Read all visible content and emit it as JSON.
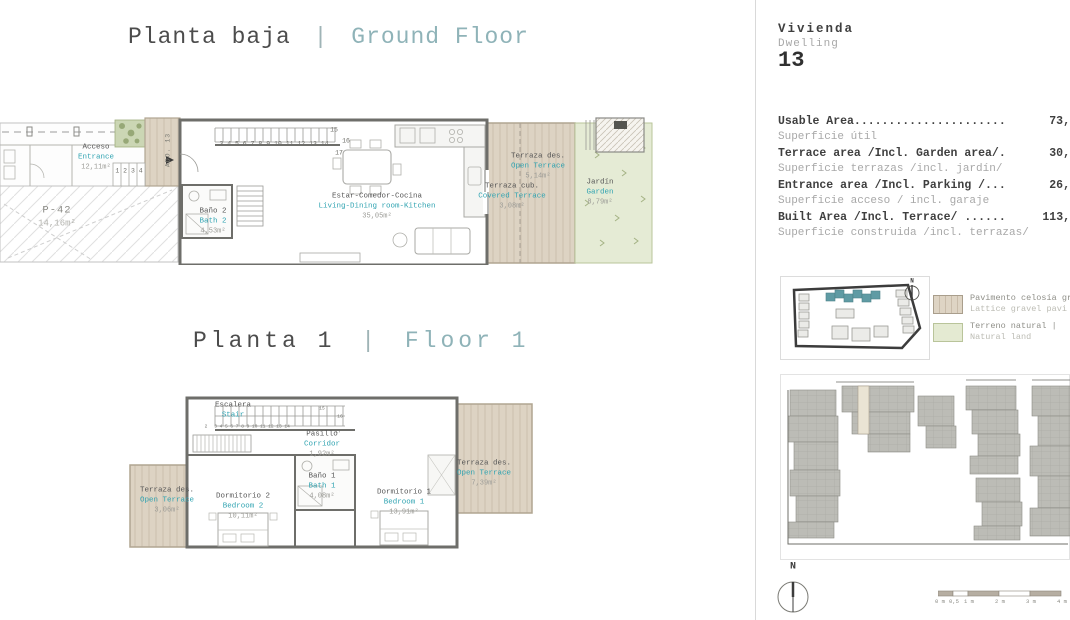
{
  "titles": {
    "ground": {
      "es": "Planta baja",
      "sep": "|",
      "en": "Ground Floor"
    },
    "first": {
      "es": "Planta 1",
      "sep": "|",
      "en": "Floor 1"
    }
  },
  "ground_floor": {
    "rooms": [
      {
        "id": "acceso",
        "es": "Acceso",
        "en": "Entrance",
        "area": "12,11m²"
      },
      {
        "id": "parking",
        "es": "P-42",
        "en": "",
        "area": "14,16m²"
      },
      {
        "id": "bano2",
        "es": "Baño 2",
        "en": "Bath 2",
        "area": "4,53m²"
      },
      {
        "id": "estar",
        "es": "Estar-Comedor-Cocina",
        "en": "Living-Dining room-Kitchen",
        "area": "35,05m²"
      },
      {
        "id": "terraza-des",
        "es": "Terraza des.",
        "en": "Open Terrace",
        "area": "5,14m²"
      },
      {
        "id": "terraza-cub",
        "es": "Terraza cub.",
        "en": "Covered Terrace",
        "area": "3,08m²"
      },
      {
        "id": "jardin",
        "es": "Jardín",
        "en": "Garden",
        "area": "8,79m²"
      }
    ],
    "entry_steps": "1 2 3 4",
    "stair_numbers": "3 4 5 6 7 8 9 10 11 12 13 14",
    "stair_n15": "15",
    "stair_n16": "16",
    "stair_n17": "17",
    "access_tag": "ADO. 13"
  },
  "first_floor": {
    "rooms": [
      {
        "id": "escalera",
        "es": "Escalera",
        "en": "Stair",
        "area": ""
      },
      {
        "id": "pasillo",
        "es": "Pasillo",
        "en": "Corridor",
        "area": "1,92m²"
      },
      {
        "id": "bano1",
        "es": "Baño 1",
        "en": "Bath 1",
        "area": "4,08m²"
      },
      {
        "id": "dorm2",
        "es": "Dormitorio 2",
        "en": "Bedroom 2",
        "area": "10,11m²"
      },
      {
        "id": "dorm1",
        "es": "Dormitorio 1",
        "en": "Bedroom 1",
        "area": "13,91m²"
      },
      {
        "id": "terraza-izq",
        "es": "Terraza des.",
        "en": "Open Terrace",
        "area": "3,06m²"
      },
      {
        "id": "terraza-der",
        "es": "Terraza des.",
        "en": "Open Terrace",
        "area": "7,39m²"
      }
    ],
    "stair_numbers": "3 4 5 6 7 8 9 10 11 12 13 14",
    "stair_n2": "2",
    "stair_n15": "15",
    "stair_n16": "16",
    "stair_n17": "17"
  },
  "panel": {
    "vivienda": "Vivienda",
    "dwelling": "Dwelling",
    "number": "13",
    "areas": [
      {
        "en": "Usable Area......................",
        "es": "Superficie útil",
        "value": "73,"
      },
      {
        "en": "Terrace area /Incl. Garden area/.",
        "es": "Superficie terrazas /incl. jardín/",
        "value": "30,"
      },
      {
        "en": "Entrance area /Incl. Parking /...",
        "es": "Superficie acceso / incl. garaje",
        "value": "26,"
      },
      {
        "en": "Built Area /Incl. Terrace/ ......",
        "es": "Superficie construida /incl. terrazas/",
        "value": "113,"
      }
    ],
    "legend": [
      {
        "es": "Pavimento celosía gr",
        "en": "Lattice gravel pavi"
      },
      {
        "es": "Terreno natural |",
        "en": "Natural land"
      }
    ],
    "north": "N",
    "scale_labels": [
      "0 m",
      "0,5",
      "1 m",
      "2 m",
      "3 m",
      "4 m"
    ]
  },
  "colors": {
    "title_teal": "#8fb3b8",
    "label_teal": "#2fa3b1",
    "deck_beige": "#ddd3c3",
    "garden_green": "#e5ebd5",
    "site_building_gray": "#bcbcb6",
    "highlight_unit": "#eae4d4"
  }
}
